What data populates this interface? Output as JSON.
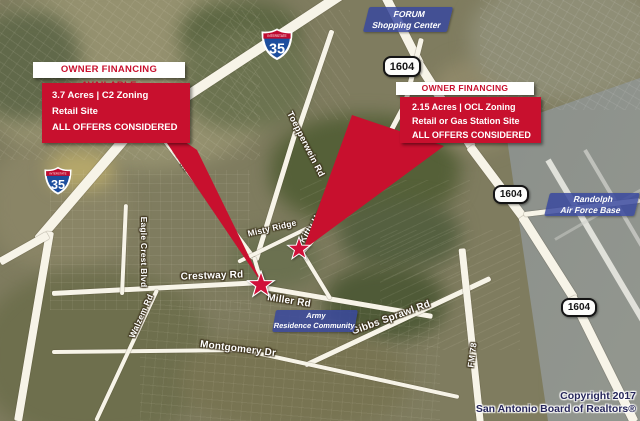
{
  "callouts": {
    "left": {
      "header": "OWNER FINANCING AVAILABLE",
      "line1": "3.7 Acres | C2 Zoning",
      "line2": "Retail Site",
      "line3": "ALL OFFERS CONSIDERED"
    },
    "right": {
      "header": "OWNER FINANCING AVAILABLE",
      "line1": "2.15 Acres | OCL Zoning",
      "line2": "Retail or Gas Station Site",
      "line3": "ALL OFFERS CONSIDERED"
    }
  },
  "shields": {
    "interstate_label": "INTERSTATE",
    "interstate_number": "35",
    "loop_number": "1604"
  },
  "area_labels": {
    "forum": {
      "line1": "FORUM",
      "line2": "Shopping Center"
    },
    "randolph": {
      "line1": "Randolph",
      "line2": "Air Force Base"
    },
    "army": {
      "line1": "Army",
      "line2": "Residence Community"
    }
  },
  "road_labels": {
    "toepperwein_upper": "Toepperwein Rd",
    "toepperwein_lower": "Toepperwein Rd",
    "kitty_hawk": "Kitty Hawk Rd",
    "misty_ridge": "Misty Ridge",
    "crestway": "Crestway Rd",
    "miller": "Miller Rd",
    "gibbs_sprawl": "Gibbs Sprawl Rd",
    "montgomery": "Montgomery Dr",
    "eagle_crest": "Eagle Crest Blvd",
    "walzem": "Walzem Rd",
    "fm78": "FM 78"
  },
  "copyright": {
    "line1": "Copyright 2017",
    "line2": "San Antonio Board of Realtors®"
  },
  "colors": {
    "callout_red": "#C8102E",
    "area_label_blue": "#38489E",
    "interstate_shield_blue": "#1D4E9E",
    "interstate_shield_red": "#BF0A30",
    "star_red": "#D1103A",
    "road_white": "#F7F4E8"
  }
}
